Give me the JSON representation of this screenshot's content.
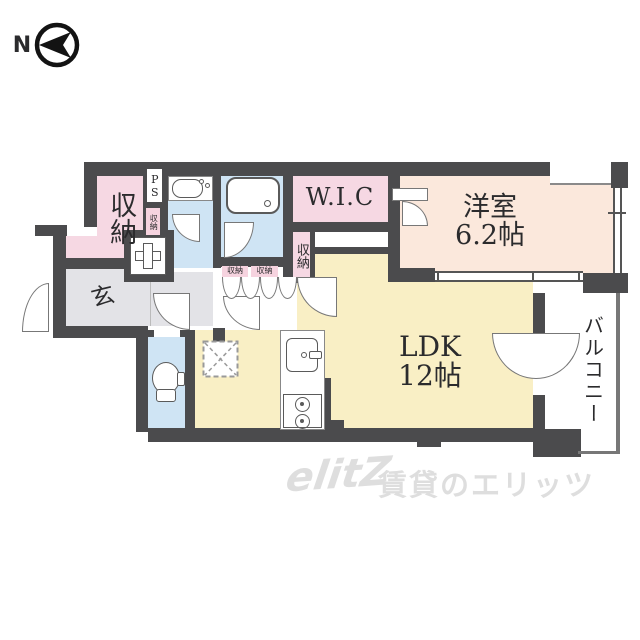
{
  "north": {
    "label": "N"
  },
  "rooms": {
    "storage_main": {
      "label": "収納"
    },
    "ps": {
      "label": "PS"
    },
    "storage_ps": {
      "label": "収納"
    },
    "wic": {
      "label": "W.I.C"
    },
    "western_room": {
      "name": "洋室",
      "size": "6.2帖"
    },
    "storage_strip": {
      "label": "収納"
    },
    "storage_tiny_a": {
      "label": "収納"
    },
    "storage_tiny_b": {
      "label": "収納"
    },
    "entrance": {
      "label": "玄"
    },
    "ldk": {
      "name": "LDK",
      "size": "12帖"
    },
    "balcony": {
      "label": "バルコニー"
    }
  },
  "watermark": {
    "logo": "elitZ",
    "text": "賃貸のエリッツ"
  },
  "colors": {
    "wall": "#4b4b4d",
    "storage_pink": "#f6d8e3",
    "wic_pink": "#f6d8e3",
    "western_peach": "#fbe8dc",
    "wet_blue": "#cfe4f4",
    "ldk_yellow": "#f9efc5",
    "hall_gray": "#e3e3e7",
    "watermark_gray": "#dedede"
  }
}
